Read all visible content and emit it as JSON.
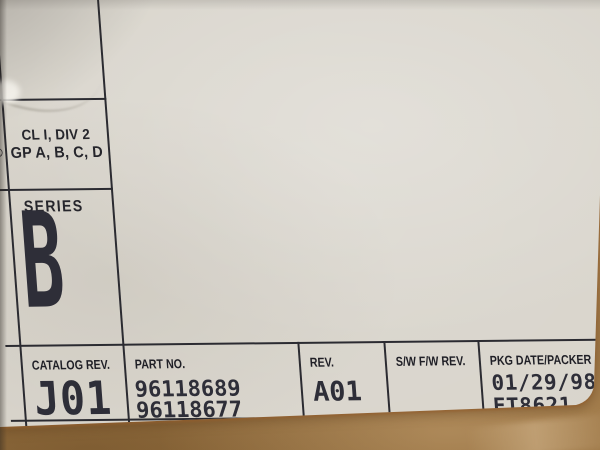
{
  "colors": {
    "paper": "#d8d4cb",
    "cardboard": "#a87e4c",
    "ink": "#2b2b31",
    "dot_matrix_text": "#2e2e38"
  },
  "certification": {
    "mark": "®",
    "line1": "CL I, DIV 2",
    "line2": "GP A, B, C, D"
  },
  "series": {
    "heading": "SERIES",
    "value": "B"
  },
  "table": {
    "catalog": {
      "header": "CATALOG REV.",
      "value": "J01"
    },
    "part": {
      "header": "PART NO.",
      "line1": "96118689",
      "line2": "96118677"
    },
    "rev": {
      "header": "REV.",
      "value": "A01"
    },
    "swfw": {
      "header": "S/W F/W REV.",
      "value": ""
    },
    "pkg": {
      "header": "PKG DATE/PACKER",
      "date": "01/29/98",
      "packer": "ET8621"
    }
  }
}
